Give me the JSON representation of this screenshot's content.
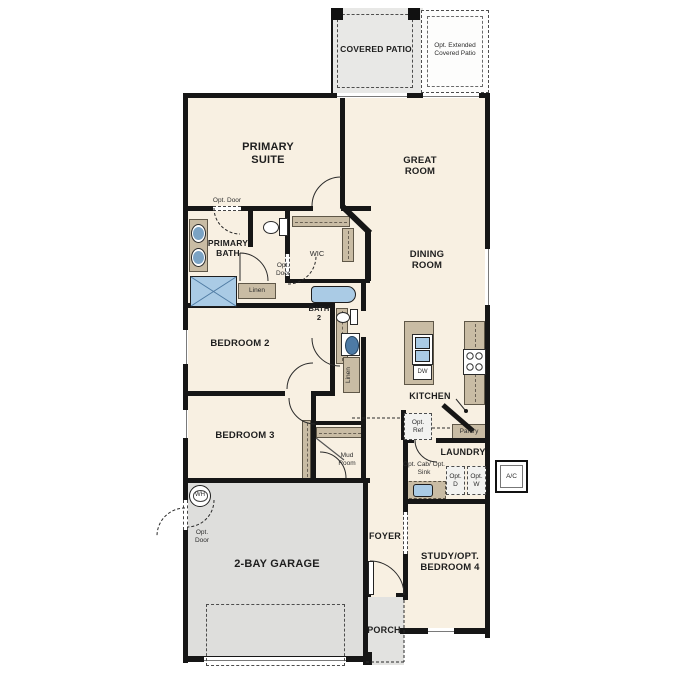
{
  "outdoor": {
    "covered_patio": "COVERED PATIO",
    "opt_extended_patio": "Opt. Extended Covered Patio",
    "porch": "PORCH",
    "ac": "A/C"
  },
  "rooms": {
    "primary_suite": "PRIMARY SUITE",
    "great_room": "GREAT ROOM",
    "primary_bath": "PRIMARY BATH",
    "wic": "WIC",
    "dining_room": "DINING ROOM",
    "bath_2": "BATH 2",
    "bedroom_2": "BEDROOM 2",
    "bedroom_3": "BEDROOM 3",
    "kitchen": "KITCHEN",
    "laundry": "LAUNDRY",
    "mud_room": "Mud Room",
    "foyer": "FOYER",
    "study": "STUDY/OPT. BEDROOM 4",
    "garage": "2-BAY GARAGE"
  },
  "labels": {
    "opt_door": "Opt. Door",
    "linen": "Linen",
    "pantry": "Pantry",
    "opt_ref": "Opt. Ref",
    "opt_cab_sink": "Opt. Cab/ Opt. Sink",
    "opt_dryer": "Opt. D",
    "opt_washer": "Opt. W",
    "water_heater": "WH",
    "dishwasher": "DW"
  },
  "colors": {
    "wall": "#161616",
    "floor": "#f8f0e2",
    "concrete": "#e2e2e0",
    "counter": "#c9bca4",
    "fixture_blue": "#aacbe5"
  }
}
